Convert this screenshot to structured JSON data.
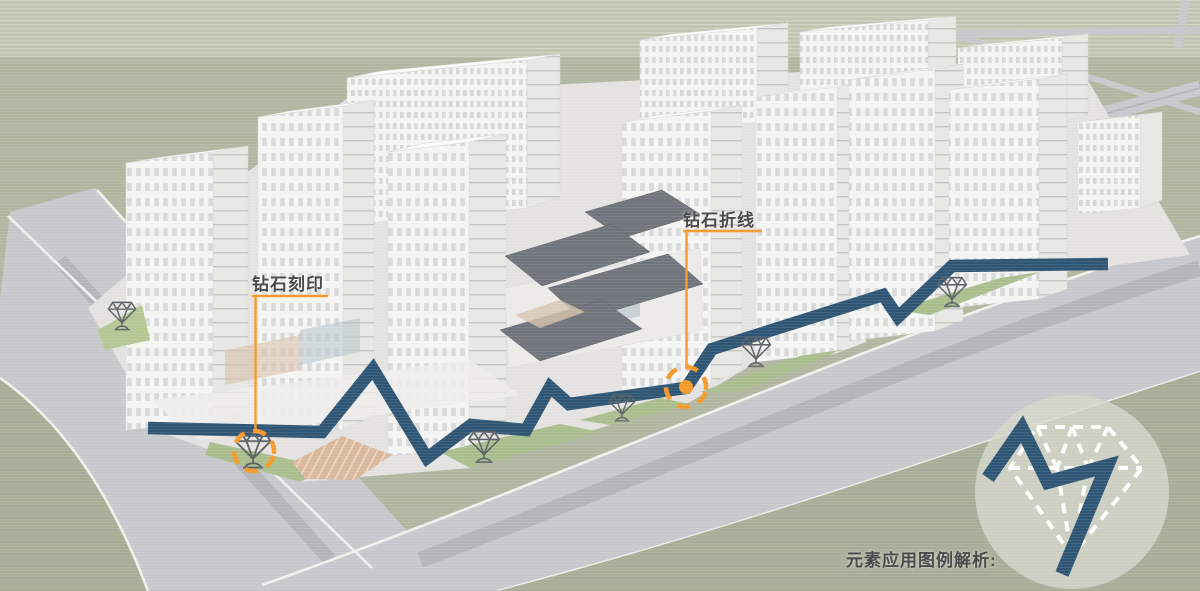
{
  "labels": {
    "diamond_imprint": "钻石刻印",
    "diamond_polyline": "钻石折线",
    "legend_caption": "元素应用图例解析:"
  },
  "colors": {
    "background_green": "#b1b6a1",
    "background_green_top": "#bdc3ae",
    "grass_dark": "#a8ad97",
    "verge_green": "#a9bd8d",
    "patch_green": "#b5c693",
    "road_gray": "#c7c8cb",
    "road_stripe": "#b4b5b9",
    "curb_white": "#f0f0ec",
    "pavement": "#e3e2e0",
    "building_face": "#f4f4f2",
    "building_side": "#e7e7e4",
    "building_roof": "#fbfbf9",
    "dark_roof": "#70747b",
    "plaza_tan": "#d9b79b",
    "promenade_blue": "#2e5674",
    "annotation_orange": "#f59a28",
    "legend_circle": "#d4d7ca",
    "label_text": "#4b4b4d"
  },
  "promenade": {
    "points": "148,428 322,432 373,369 427,458 471,425 526,430 550,387 569,404 686,388 712,349 883,295 898,317 952,266 1108,264",
    "stroke_width": 12.5
  },
  "legend": {
    "zigzag_points": "988,478 1022,429 1048,482 1107,466 1062,574",
    "circle": {
      "cx": 1072,
      "cy": 492,
      "r": 97
    }
  },
  "callouts": [
    {
      "id": "imprint",
      "label_key": "diamond_imprint",
      "label_pos": [
        252,
        270
      ],
      "underline": [
        252,
        296,
        328,
        296
      ],
      "leader": [
        255.5,
        297,
        255.5,
        429
      ],
      "circle": {
        "cx": 254,
        "cy": 451,
        "r": 20
      },
      "dot": false
    },
    {
      "id": "polyline",
      "label_key": "diamond_polyline",
      "label_pos": [
        683,
        206
      ],
      "underline": [
        683,
        231,
        762,
        231
      ],
      "leader": [
        686.5,
        232,
        686.5,
        365
      ],
      "circle": {
        "cx": 686,
        "cy": 387,
        "r": 20
      },
      "dot": true
    }
  ],
  "diamond_markers": [
    {
      "x": 122,
      "y": 316,
      "s": 0.85
    },
    {
      "x": 253,
      "y": 450,
      "s": 1.1
    },
    {
      "x": 484,
      "y": 447,
      "s": 0.95
    },
    {
      "x": 622,
      "y": 408,
      "s": 0.8
    },
    {
      "x": 756,
      "y": 352,
      "s": 0.9
    },
    {
      "x": 952,
      "y": 292,
      "s": 0.9
    }
  ]
}
